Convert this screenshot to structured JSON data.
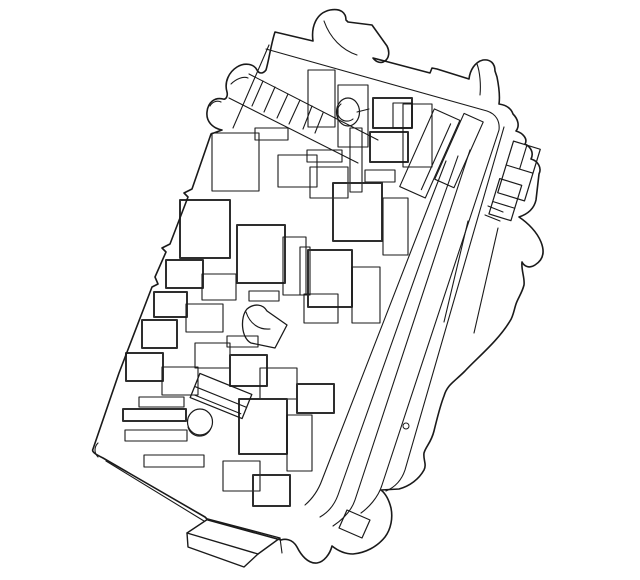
{
  "colors": {
    "background": "#ffffff",
    "ink": "#1a1a1a",
    "ink_heavy": "#2e2e2e"
  },
  "illustration": {
    "kind": "fuse-box-line-drawing",
    "outer_silhouette": {
      "w": 1.6,
      "d": "M 93,449 L 119,373 L 152,287 L 158,284 L 155,277 L 166,252 L 162,248 L 170,244 L 188,197 L 184,193 L 192,189 L 211,134 L 222,130 C 212,128 206,121 207,112 C 208,102 215,97 223,99 C 226,100 228,96 227,92 C 224,82 229,72 237,67 C 245,62 254,64 257,70 C 259,74 263,74 266,70 C 269,60 271,44 275,32 L 313,41 C 311,27 316,13 330,10 C 341,8 346,13 346,20 L 348,22 L 372,25 L 387,46 C 390,52 389,58 385,61 C 381,64 376,62 373,58 L 430,73 L 432,68 L 437,69 L 469,79 C 470,70 475,62 483,60 C 491,59 495,64 495,71 L 497,77 C 499,87 500,97 499,104 C 506,105 511,108 513,114 C 518,119 520,126 516,131 C 523,133 528,139 525,144 C 531,147 534,153 531,159 C 538,161 542,168 539,174 L 536,200 C 534,209 528,214 519,217 C 528,223 537,232 541,242 C 545,252 543,260 535,265 C 529,269 524,266 522,262 C 521,270 525,278 524,285 C 522,293 518,298 516,304 C 514,310 513,317 510,321 C 498,341 477,358 465,371 C 454,382 447,385 444,396 C 440,406 437,419 434,431 C 431,443 426,446 424,453 C 423,460 427,464 424,470 C 419,479 410,486 399,489 L 381,490 C 386,494 389,500 391,508 C 393,518 391,529 385,537 C 377,547 365,553 353,554 C 344,554 337,550 332,546 C 330,554 324,562 317,563 C 308,564 301,555 297,547 C 292,538 284,539 281,540 L 208,520 L 205,517 L 103,458 C 97,455 91,452 93,449 Z"
    },
    "detail_paths": [
      {
        "n": "inner-top-rim",
        "w": 1.1,
        "d": "M 266,49 L 487,111 C 496,114 500,121 499,130 L 382,485 C 378,498 368,508 361,513"
      },
      {
        "n": "thumb-inner-arc",
        "w": 1.1,
        "d": "M 231,84 C 236,79 243,76 248,78"
      },
      {
        "n": "small-thumb-arc",
        "w": 1.1,
        "d": "M 210,106 C 212,102 217,100 221,102"
      },
      {
        "n": "top-tab-inner-arc",
        "w": 1.1,
        "d": "M 324,21 C 330,38 342,50 357,55"
      },
      {
        "n": "right-tab-inner-line",
        "w": 1.1,
        "d": "M 477,64 C 480,72 481,85 480,95"
      },
      {
        "n": "corner-inner-arc",
        "w": 1.1,
        "d": "M 98,443 C 94,447 94,453 98,457"
      },
      {
        "n": "bottom-wall-line",
        "w": 1.1,
        "d": "M 106,461 L 204,521"
      },
      {
        "n": "foot-top-face",
        "w": 1.4,
        "d": "M 187,533 L 208,519 L 280,538 L 258,554 Z"
      },
      {
        "n": "foot-front-face",
        "w": 1.4,
        "d": "M 187,533 L 188,547 L 244,567 L 258,554"
      },
      {
        "n": "foot-tick",
        "w": 1.1,
        "d": "M 280,538 L 282,553"
      },
      {
        "n": "latch-slot",
        "w": 1.2,
        "d": "M 347,510 L 370,520 L 362,538 L 339,528 Z"
      },
      {
        "n": "lug-face-line-a",
        "w": 1.1,
        "d": "M 468,221 L 444,322"
      },
      {
        "n": "lug-face-line-b",
        "w": 1.1,
        "d": "M 498,228 L 474,333"
      },
      {
        "n": "lug-step-a",
        "w": 1.1,
        "d": "M 488,206 L 503,212"
      },
      {
        "n": "lug-step-b",
        "w": 1.1,
        "d": "M 485,215 L 500,221"
      },
      {
        "n": "blob-clip",
        "w": 1.3,
        "d": "M 247,309 C 254,303 263,304 267,311 L 287,325 L 275,348 L 251,343 C 241,338 240,317 247,309 Z"
      },
      {
        "n": "blob-inner-curve",
        "w": 1.1,
        "d": "M 246,312 C 250,324 259,330 270,329"
      },
      {
        "n": "ring-inner-arc",
        "w": 1.1,
        "d": "M 188,427 A 12,12 0 0 0 211,428"
      },
      {
        "n": "post-inner-arc",
        "w": 1.1,
        "d": "M 341,104 A 8,8 0 1 0 353,119"
      },
      {
        "n": "post-link-line",
        "w": 1.1,
        "d": "M 357,112 L 369,109"
      }
    ],
    "band_lines": [
      {
        "w": 1.1,
        "d": "M 504,127 L 405,470 C 401,482 393,488 386,491"
      },
      {
        "w": 1.1,
        "d": "M 470,150 L 355,500 C 351,512 342,520 333,526"
      },
      {
        "w": 1.1,
        "d": "M 458,156 L 338,495 C 334,506 327,513 320,517"
      },
      {
        "w": 1.1,
        "d": "M 446,161 L 322,480 C 318,491 312,499 305,505"
      }
    ],
    "hatch_lines": [
      {
        "w": 1.1,
        "d": "M 249,74 L 378,140"
      },
      {
        "w": 1.1,
        "d": "M 229,98 L 358,163"
      },
      {
        "w": 1.1,
        "d": "M 269,45 L 233,128"
      },
      {
        "w": 1.1,
        "d": "M 263,81 L 252,106"
      },
      {
        "w": 1.1,
        "d": "M 275,87 L 264,112"
      },
      {
        "w": 1.1,
        "d": "M 288,94 L 277,118"
      },
      {
        "w": 1.1,
        "d": "M 300,100 L 289,124"
      },
      {
        "w": 1.1,
        "d": "M 312,106 L 303,129"
      },
      {
        "w": 1.1,
        "d": "M 323,113 L 315,133"
      }
    ],
    "fuse_rects": [
      {
        "x": 308,
        "y": 70,
        "w": 27,
        "h": 57,
        "lw": 1.1
      },
      {
        "x": 338,
        "y": 85,
        "w": 30,
        "h": 62,
        "lw": 1.1
      },
      {
        "x": 373,
        "y": 98,
        "w": 39,
        "h": 30,
        "lw": 2
      },
      {
        "x": 393,
        "y": 103,
        "w": 19,
        "h": 25,
        "lw": 1.1
      },
      {
        "x": 370,
        "y": 132,
        "w": 38,
        "h": 30,
        "lw": 2
      },
      {
        "x": 403,
        "y": 104,
        "w": 29,
        "h": 63,
        "lw": 1.1
      },
      {
        "x": 350,
        "y": 128,
        "w": 12,
        "h": 64,
        "lw": 1.1
      },
      {
        "x": 212,
        "y": 133,
        "w": 47,
        "h": 58,
        "lw": 1.1
      },
      {
        "x": 255,
        "y": 128,
        "w": 33,
        "h": 12,
        "lw": 1.1
      },
      {
        "x": 278,
        "y": 155,
        "w": 39,
        "h": 32,
        "lw": 1.1
      },
      {
        "x": 307,
        "y": 150,
        "w": 35,
        "h": 12,
        "lw": 1.1
      },
      {
        "x": 310,
        "y": 167,
        "w": 38,
        "h": 31,
        "lw": 1.1
      },
      {
        "x": 333,
        "y": 183,
        "w": 49,
        "h": 58,
        "lw": 2
      },
      {
        "x": 365,
        "y": 170,
        "w": 30,
        "h": 12,
        "lw": 1.1
      },
      {
        "x": 383,
        "y": 198,
        "w": 25,
        "h": 57,
        "lw": 1.1
      },
      {
        "x": 300,
        "y": 247,
        "w": 10,
        "h": 48,
        "lw": 1.1
      },
      {
        "x": 308,
        "y": 250,
        "w": 44,
        "h": 57,
        "lw": 2
      },
      {
        "x": 352,
        "y": 267,
        "w": 28,
        "h": 56,
        "lw": 1.1
      },
      {
        "x": 180,
        "y": 200,
        "w": 50,
        "h": 58,
        "lw": 2
      },
      {
        "x": 237,
        "y": 225,
        "w": 48,
        "h": 58,
        "lw": 2
      },
      {
        "x": 283,
        "y": 237,
        "w": 23,
        "h": 58,
        "lw": 1.1
      },
      {
        "x": 166,
        "y": 260,
        "w": 37,
        "h": 28,
        "lw": 2
      },
      {
        "x": 202,
        "y": 274,
        "w": 34,
        "h": 26,
        "lw": 1.1
      },
      {
        "x": 154,
        "y": 292,
        "w": 33,
        "h": 25,
        "lw": 2
      },
      {
        "x": 186,
        "y": 304,
        "w": 37,
        "h": 28,
        "lw": 1.1
      },
      {
        "x": 142,
        "y": 320,
        "w": 35,
        "h": 28,
        "lw": 2
      },
      {
        "x": 126,
        "y": 353,
        "w": 37,
        "h": 28,
        "lw": 2
      },
      {
        "x": 162,
        "y": 367,
        "w": 36,
        "h": 28,
        "lw": 1.1
      },
      {
        "x": 249,
        "y": 291,
        "w": 30,
        "h": 10,
        "lw": 1.1
      },
      {
        "x": 195,
        "y": 343,
        "w": 35,
        "h": 25,
        "lw": 1.1
      },
      {
        "x": 304,
        "y": 294,
        "w": 34,
        "h": 29,
        "lw": 1.1
      },
      {
        "x": 230,
        "y": 355,
        "w": 37,
        "h": 31,
        "lw": 2
      },
      {
        "x": 260,
        "y": 368,
        "w": 37,
        "h": 31,
        "lw": 1.1
      },
      {
        "x": 239,
        "y": 399,
        "w": 48,
        "h": 55,
        "lw": 2
      },
      {
        "x": 287,
        "y": 415,
        "w": 25,
        "h": 56,
        "lw": 1.1
      },
      {
        "x": 297,
        "y": 384,
        "w": 37,
        "h": 29,
        "lw": 2
      },
      {
        "x": 223,
        "y": 461,
        "w": 37,
        "h": 30,
        "lw": 1.1
      },
      {
        "x": 253,
        "y": 475,
        "w": 37,
        "h": 31,
        "lw": 2
      },
      {
        "x": 227,
        "y": 336,
        "w": 31,
        "h": 11,
        "lw": 1.1
      },
      {
        "x": 139,
        "y": 397,
        "w": 45,
        "h": 10,
        "lw": 1.1
      },
      {
        "x": 123,
        "y": 409,
        "w": 63,
        "h": 12,
        "lw": 2
      },
      {
        "x": 125,
        "y": 430,
        "w": 62,
        "h": 11,
        "lw": 1.1
      },
      {
        "x": 144,
        "y": 455,
        "w": 60,
        "h": 12,
        "lw": 1.1
      }
    ],
    "rotated_groups": [
      {
        "n": "relay-tilted-top",
        "rotate": "24 430 153",
        "rects": [
          {
            "x": 416,
            "y": 111,
            "w": 28,
            "h": 85,
            "lw": 1.1
          },
          {
            "x": 445,
            "y": 103,
            "w": 21,
            "h": 72,
            "lw": 1.1
          }
        ],
        "lines": [
          {
            "x1": 437,
            "y1": 118,
            "x2": 437,
            "y2": 190,
            "lw": 1.1
          }
        ]
      },
      {
        "n": "relay-tilted-bottom",
        "rotate": "22 221 396",
        "rects": [
          {
            "x": 193,
            "y": 383,
            "w": 56,
            "h": 26,
            "lw": 1.3
          }
        ],
        "lines": [
          {
            "x1": 193,
            "y1": 397,
            "x2": 249,
            "y2": 397,
            "lw": 1.1
          },
          {
            "x1": 196,
            "y1": 405,
            "x2": 246,
            "y2": 405,
            "lw": 1.1
          }
        ]
      },
      {
        "n": "flange-connector-upper",
        "rotate": "17 519 171",
        "rects": [
          {
            "x": 505,
            "y": 144,
            "w": 28,
            "h": 54,
            "lw": 1.2
          }
        ],
        "lines": [
          {
            "x1": 505,
            "y1": 169,
            "x2": 533,
            "y2": 169,
            "lw": 1.1
          },
          {
            "x1": 519,
            "y1": 144,
            "x2": 519,
            "y2": 169,
            "lw": 1.1
          }
        ]
      },
      {
        "n": "flange-connector-lower",
        "rotate": "17 505 199",
        "rects": [
          {
            "x": 494,
            "y": 181,
            "w": 23,
            "h": 37,
            "lw": 1.2
          }
        ],
        "lines": [
          {
            "x1": 494,
            "y1": 205,
            "x2": 517,
            "y2": 205,
            "lw": 1.1
          }
        ]
      }
    ],
    "ellipses": [
      {
        "n": "mount-ring",
        "cx": 200,
        "cy": 422,
        "rx": 12.5,
        "ry": 13,
        "lw": 1.2
      },
      {
        "n": "round-post",
        "cx": 348,
        "cy": 112,
        "rx": 11.5,
        "ry": 14,
        "lw": 1.2
      },
      {
        "n": "latch-pin",
        "cx": 406,
        "cy": 426,
        "rx": 3,
        "ry": 3,
        "lw": 1.0
      }
    ]
  }
}
